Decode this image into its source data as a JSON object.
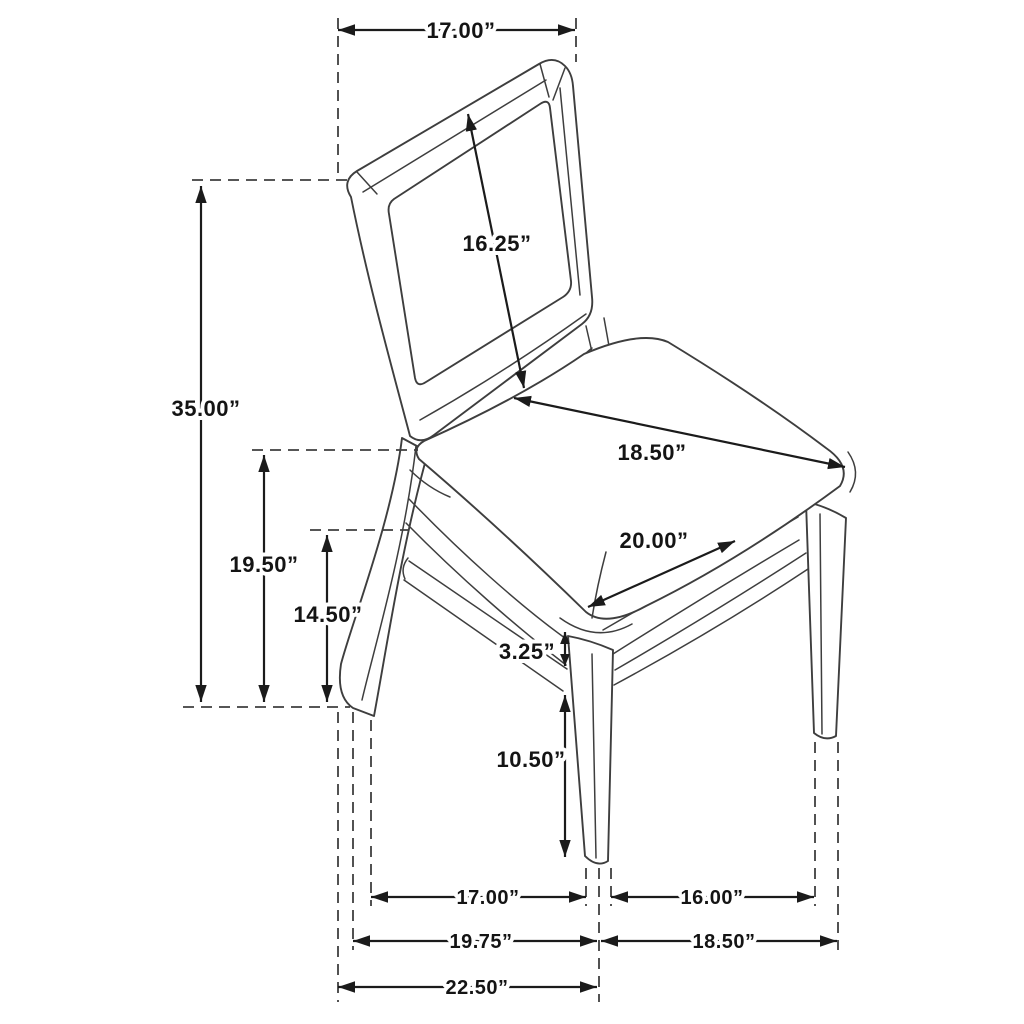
{
  "diagram": {
    "subject": "dining-side-chair-with-cane-back",
    "unit": "inches",
    "background_color": "#ffffff",
    "chair_line_color": "#3e3e3e",
    "dimension_line_color": "#1b1b1b",
    "label_text_color": "#141414",
    "label_halo_color": "#ffffff"
  },
  "dims": [
    {
      "id": "back-width",
      "value": "17.00”"
    },
    {
      "id": "back-panel-height",
      "value": "16.25”"
    },
    {
      "id": "overall-height",
      "value": "35.00”"
    },
    {
      "id": "seat-back-height",
      "value": "19.50”"
    },
    {
      "id": "seat-frame-height",
      "value": "14.50”"
    },
    {
      "id": "seat-width",
      "value": "18.50”"
    },
    {
      "id": "seat-depth",
      "value": "20.00”"
    },
    {
      "id": "apron-thickness",
      "value": "3.25”"
    },
    {
      "id": "front-leg-clearance",
      "value": "10.50”"
    },
    {
      "id": "feet-span-side",
      "value": "17.00”"
    },
    {
      "id": "feet-span-front",
      "value": "16.00”"
    },
    {
      "id": "footprint-depth",
      "value": "19.75”"
    },
    {
      "id": "footprint-width",
      "value": "18.50”"
    },
    {
      "id": "overall-depth",
      "value": "22.50”"
    }
  ]
}
